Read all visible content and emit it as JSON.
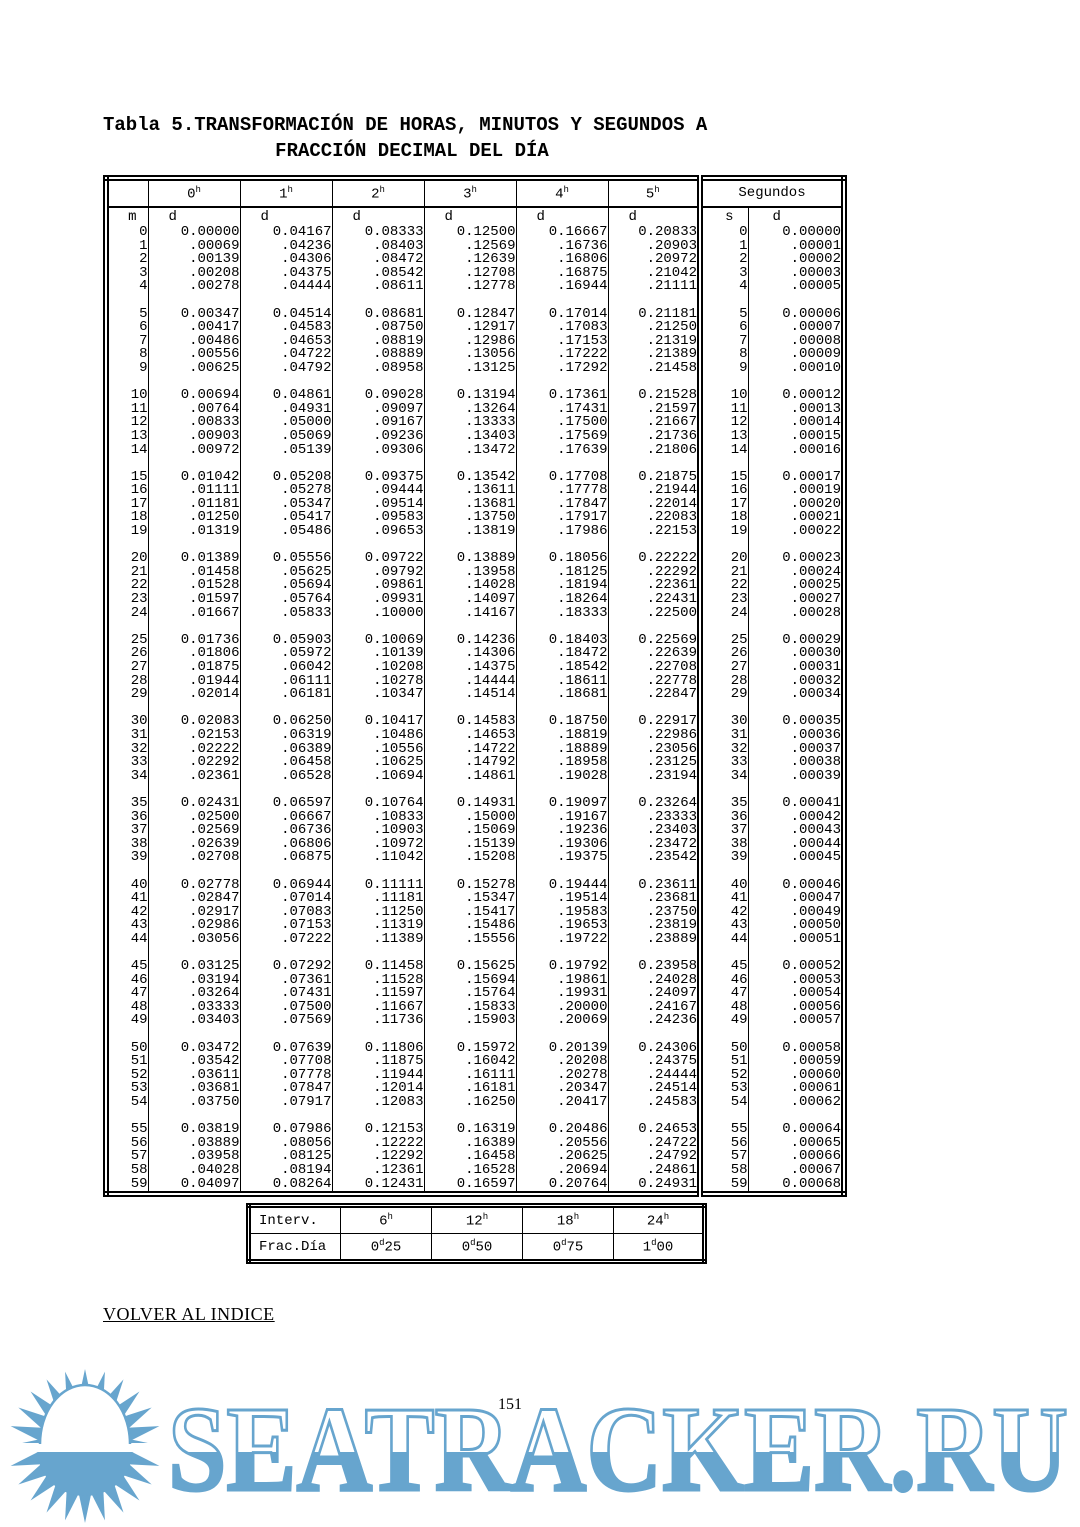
{
  "title": {
    "line1": "Tabla 5.TRANSFORMACIÓN DE HORAS, MINUTOS Y SEGUNDOS A",
    "line2": "FRACCIÓN DECIMAL DEL DÍA"
  },
  "colors": {
    "watermark_blue": "#67a5ce",
    "text": "#000000"
  },
  "table": {
    "hour_headers": [
      {
        "v": "0",
        "sup": "h"
      },
      {
        "v": "1",
        "sup": "h"
      },
      {
        "v": "2",
        "sup": "h"
      },
      {
        "v": "3",
        "sup": "h"
      },
      {
        "v": "4",
        "sup": "h"
      },
      {
        "v": "5",
        "sup": "h"
      }
    ],
    "segundos_header": "Segundos",
    "subheader": {
      "m": "m",
      "d": "d",
      "s": "s"
    },
    "group_size": 5,
    "rows": [
      [
        "0",
        "0.00000",
        "0.04167",
        "0.08333",
        "0.12500",
        "0.16667",
        "0.20833",
        "0",
        "0.00000"
      ],
      [
        "1",
        ".00069",
        ".04236",
        ".08403",
        ".12569",
        ".16736",
        ".20903",
        "1",
        ".00001"
      ],
      [
        "2",
        ".00139",
        ".04306",
        ".08472",
        ".12639",
        ".16806",
        ".20972",
        "2",
        ".00002"
      ],
      [
        "3",
        ".00208",
        ".04375",
        ".08542",
        ".12708",
        ".16875",
        ".21042",
        "3",
        ".00003"
      ],
      [
        "4",
        ".00278",
        ".04444",
        ".08611",
        ".12778",
        ".16944",
        ".21111",
        "4",
        ".00005"
      ],
      [
        "5",
        "0.00347",
        "0.04514",
        "0.08681",
        "0.12847",
        "0.17014",
        "0.21181",
        "5",
        "0.00006"
      ],
      [
        "6",
        ".00417",
        ".04583",
        ".08750",
        ".12917",
        ".17083",
        ".21250",
        "6",
        ".00007"
      ],
      [
        "7",
        ".00486",
        ".04653",
        ".08819",
        ".12986",
        ".17153",
        ".21319",
        "7",
        ".00008"
      ],
      [
        "8",
        ".00556",
        ".04722",
        ".08889",
        ".13056",
        ".17222",
        ".21389",
        "8",
        ".00009"
      ],
      [
        "9",
        ".00625",
        ".04792",
        ".08958",
        ".13125",
        ".17292",
        ".21458",
        "9",
        ".00010"
      ],
      [
        "10",
        "0.00694",
        "0.04861",
        "0.09028",
        "0.13194",
        "0.17361",
        "0.21528",
        "10",
        "0.00012"
      ],
      [
        "11",
        ".00764",
        ".04931",
        ".09097",
        ".13264",
        ".17431",
        ".21597",
        "11",
        ".00013"
      ],
      [
        "12",
        ".00833",
        ".05000",
        ".09167",
        ".13333",
        ".17500",
        ".21667",
        "12",
        ".00014"
      ],
      [
        "13",
        ".00903",
        ".05069",
        ".09236",
        ".13403",
        ".17569",
        ".21736",
        "13",
        ".00015"
      ],
      [
        "14",
        ".00972",
        ".05139",
        ".09306",
        ".13472",
        ".17639",
        ".21806",
        "14",
        ".00016"
      ],
      [
        "15",
        "0.01042",
        "0.05208",
        "0.09375",
        "0.13542",
        "0.17708",
        "0.21875",
        "15",
        "0.00017"
      ],
      [
        "16",
        ".01111",
        ".05278",
        ".09444",
        ".13611",
        ".17778",
        ".21944",
        "16",
        ".00019"
      ],
      [
        "17",
        ".01181",
        ".05347",
        ".09514",
        ".13681",
        ".17847",
        ".22014",
        "17",
        ".00020"
      ],
      [
        "18",
        ".01250",
        ".05417",
        ".09583",
        ".13750",
        ".17917",
        ".22083",
        "18",
        ".00021"
      ],
      [
        "19",
        ".01319",
        ".05486",
        ".09653",
        ".13819",
        ".17986",
        ".22153",
        "19",
        ".00022"
      ],
      [
        "20",
        "0.01389",
        "0.05556",
        "0.09722",
        "0.13889",
        "0.18056",
        "0.22222",
        "20",
        "0.00023"
      ],
      [
        "21",
        ".01458",
        ".05625",
        ".09792",
        ".13958",
        ".18125",
        ".22292",
        "21",
        ".00024"
      ],
      [
        "22",
        ".01528",
        ".05694",
        ".09861",
        ".14028",
        ".18194",
        ".22361",
        "22",
        ".00025"
      ],
      [
        "23",
        ".01597",
        ".05764",
        ".09931",
        ".14097",
        ".18264",
        ".22431",
        "23",
        ".00027"
      ],
      [
        "24",
        ".01667",
        ".05833",
        ".10000",
        ".14167",
        ".18333",
        ".22500",
        "24",
        ".00028"
      ],
      [
        "25",
        "0.01736",
        "0.05903",
        "0.10069",
        "0.14236",
        "0.18403",
        "0.22569",
        "25",
        "0.00029"
      ],
      [
        "26",
        ".01806",
        ".05972",
        ".10139",
        ".14306",
        ".18472",
        ".22639",
        "26",
        ".00030"
      ],
      [
        "27",
        ".01875",
        ".06042",
        ".10208",
        ".14375",
        ".18542",
        ".22708",
        "27",
        ".00031"
      ],
      [
        "28",
        ".01944",
        ".06111",
        ".10278",
        ".14444",
        ".18611",
        ".22778",
        "28",
        ".00032"
      ],
      [
        "29",
        ".02014",
        ".06181",
        ".10347",
        ".14514",
        ".18681",
        ".22847",
        "29",
        ".00034"
      ],
      [
        "30",
        "0.02083",
        "0.06250",
        "0.10417",
        "0.14583",
        "0.18750",
        "0.22917",
        "30",
        "0.00035"
      ],
      [
        "31",
        ".02153",
        ".06319",
        ".10486",
        ".14653",
        ".18819",
        ".22986",
        "31",
        ".00036"
      ],
      [
        "32",
        ".02222",
        ".06389",
        ".10556",
        ".14722",
        ".18889",
        ".23056",
        "32",
        ".00037"
      ],
      [
        "33",
        ".02292",
        ".06458",
        ".10625",
        ".14792",
        ".18958",
        ".23125",
        "33",
        ".00038"
      ],
      [
        "34",
        ".02361",
        ".06528",
        ".10694",
        ".14861",
        ".19028",
        ".23194",
        "34",
        ".00039"
      ],
      [
        "35",
        "0.02431",
        "0.06597",
        "0.10764",
        "0.14931",
        "0.19097",
        "0.23264",
        "35",
        "0.00041"
      ],
      [
        "36",
        ".02500",
        ".06667",
        ".10833",
        ".15000",
        ".19167",
        ".23333",
        "36",
        ".00042"
      ],
      [
        "37",
        ".02569",
        ".06736",
        ".10903",
        ".15069",
        ".19236",
        ".23403",
        "37",
        ".00043"
      ],
      [
        "38",
        ".02639",
        ".06806",
        ".10972",
        ".15139",
        ".19306",
        ".23472",
        "38",
        ".00044"
      ],
      [
        "39",
        ".02708",
        ".06875",
        ".11042",
        ".15208",
        ".19375",
        ".23542",
        "39",
        ".00045"
      ],
      [
        "40",
        "0.02778",
        "0.06944",
        "0.11111",
        "0.15278",
        "0.19444",
        "0.23611",
        "40",
        "0.00046"
      ],
      [
        "41",
        ".02847",
        ".07014",
        ".11181",
        ".15347",
        ".19514",
        ".23681",
        "41",
        ".00047"
      ],
      [
        "42",
        ".02917",
        ".07083",
        ".11250",
        ".15417",
        ".19583",
        ".23750",
        "42",
        ".00049"
      ],
      [
        "43",
        ".02986",
        ".07153",
        ".11319",
        ".15486",
        ".19653",
        ".23819",
        "43",
        ".00050"
      ],
      [
        "44",
        ".03056",
        ".07222",
        ".11389",
        ".15556",
        ".19722",
        ".23889",
        "44",
        ".00051"
      ],
      [
        "45",
        "0.03125",
        "0.07292",
        "0.11458",
        "0.15625",
        "0.19792",
        "0.23958",
        "45",
        "0.00052"
      ],
      [
        "46",
        ".03194",
        ".07361",
        ".11528",
        ".15694",
        ".19861",
        ".24028",
        "46",
        ".00053"
      ],
      [
        "47",
        ".03264",
        ".07431",
        ".11597",
        ".15764",
        ".19931",
        ".24097",
        "47",
        ".00054"
      ],
      [
        "48",
        ".03333",
        ".07500",
        ".11667",
        ".15833",
        ".20000",
        ".24167",
        "48",
        ".00056"
      ],
      [
        "49",
        ".03403",
        ".07569",
        ".11736",
        ".15903",
        ".20069",
        ".24236",
        "49",
        ".00057"
      ],
      [
        "50",
        "0.03472",
        "0.07639",
        "0.11806",
        "0.15972",
        "0.20139",
        "0.24306",
        "50",
        "0.00058"
      ],
      [
        "51",
        ".03542",
        ".07708",
        ".11875",
        ".16042",
        ".20208",
        ".24375",
        "51",
        ".00059"
      ],
      [
        "52",
        ".03611",
        ".07778",
        ".11944",
        ".16111",
        ".20278",
        ".24444",
        "52",
        ".00060"
      ],
      [
        "53",
        ".03681",
        ".07847",
        ".12014",
        ".16181",
        ".20347",
        ".24514",
        "53",
        ".00061"
      ],
      [
        "54",
        ".03750",
        ".07917",
        ".12083",
        ".16250",
        ".20417",
        ".24583",
        "54",
        ".00062"
      ],
      [
        "55",
        "0.03819",
        "0.07986",
        "0.12153",
        "0.16319",
        "0.20486",
        "0.24653",
        "55",
        "0.00064"
      ],
      [
        "56",
        ".03889",
        ".08056",
        ".12222",
        ".16389",
        ".20556",
        ".24722",
        "56",
        ".00065"
      ],
      [
        "57",
        ".03958",
        ".08125",
        ".12292",
        ".16458",
        ".20625",
        ".24792",
        "57",
        ".00066"
      ],
      [
        "58",
        ".04028",
        ".08194",
        ".12361",
        ".16528",
        ".20694",
        ".24861",
        "58",
        ".00067"
      ],
      [
        "59",
        "0.04097",
        "0.08264",
        "0.12431",
        "0.16597",
        "0.20764",
        "0.24931",
        "59",
        "0.00068"
      ]
    ],
    "footer": {
      "interv_label": "Interv.",
      "interv": [
        {
          "v": "6",
          "sup": "h"
        },
        {
          "v": "12",
          "sup": "h"
        },
        {
          "v": "18",
          "sup": "h"
        },
        {
          "v": "24",
          "sup": "h"
        }
      ],
      "frac_label": "Frac.Día",
      "frac": [
        {
          "pre": "0",
          "sup": "d",
          "post": "25"
        },
        {
          "pre": "0",
          "sup": "d",
          "post": "50"
        },
        {
          "pre": "0",
          "sup": "d",
          "post": "75"
        },
        {
          "pre": "1",
          "sup": "d",
          "post": "00"
        }
      ]
    }
  },
  "link": {
    "text": "VOLVER AL INDICE"
  },
  "page_number": "151",
  "watermark": {
    "text": "SEATRACKER.RU"
  }
}
